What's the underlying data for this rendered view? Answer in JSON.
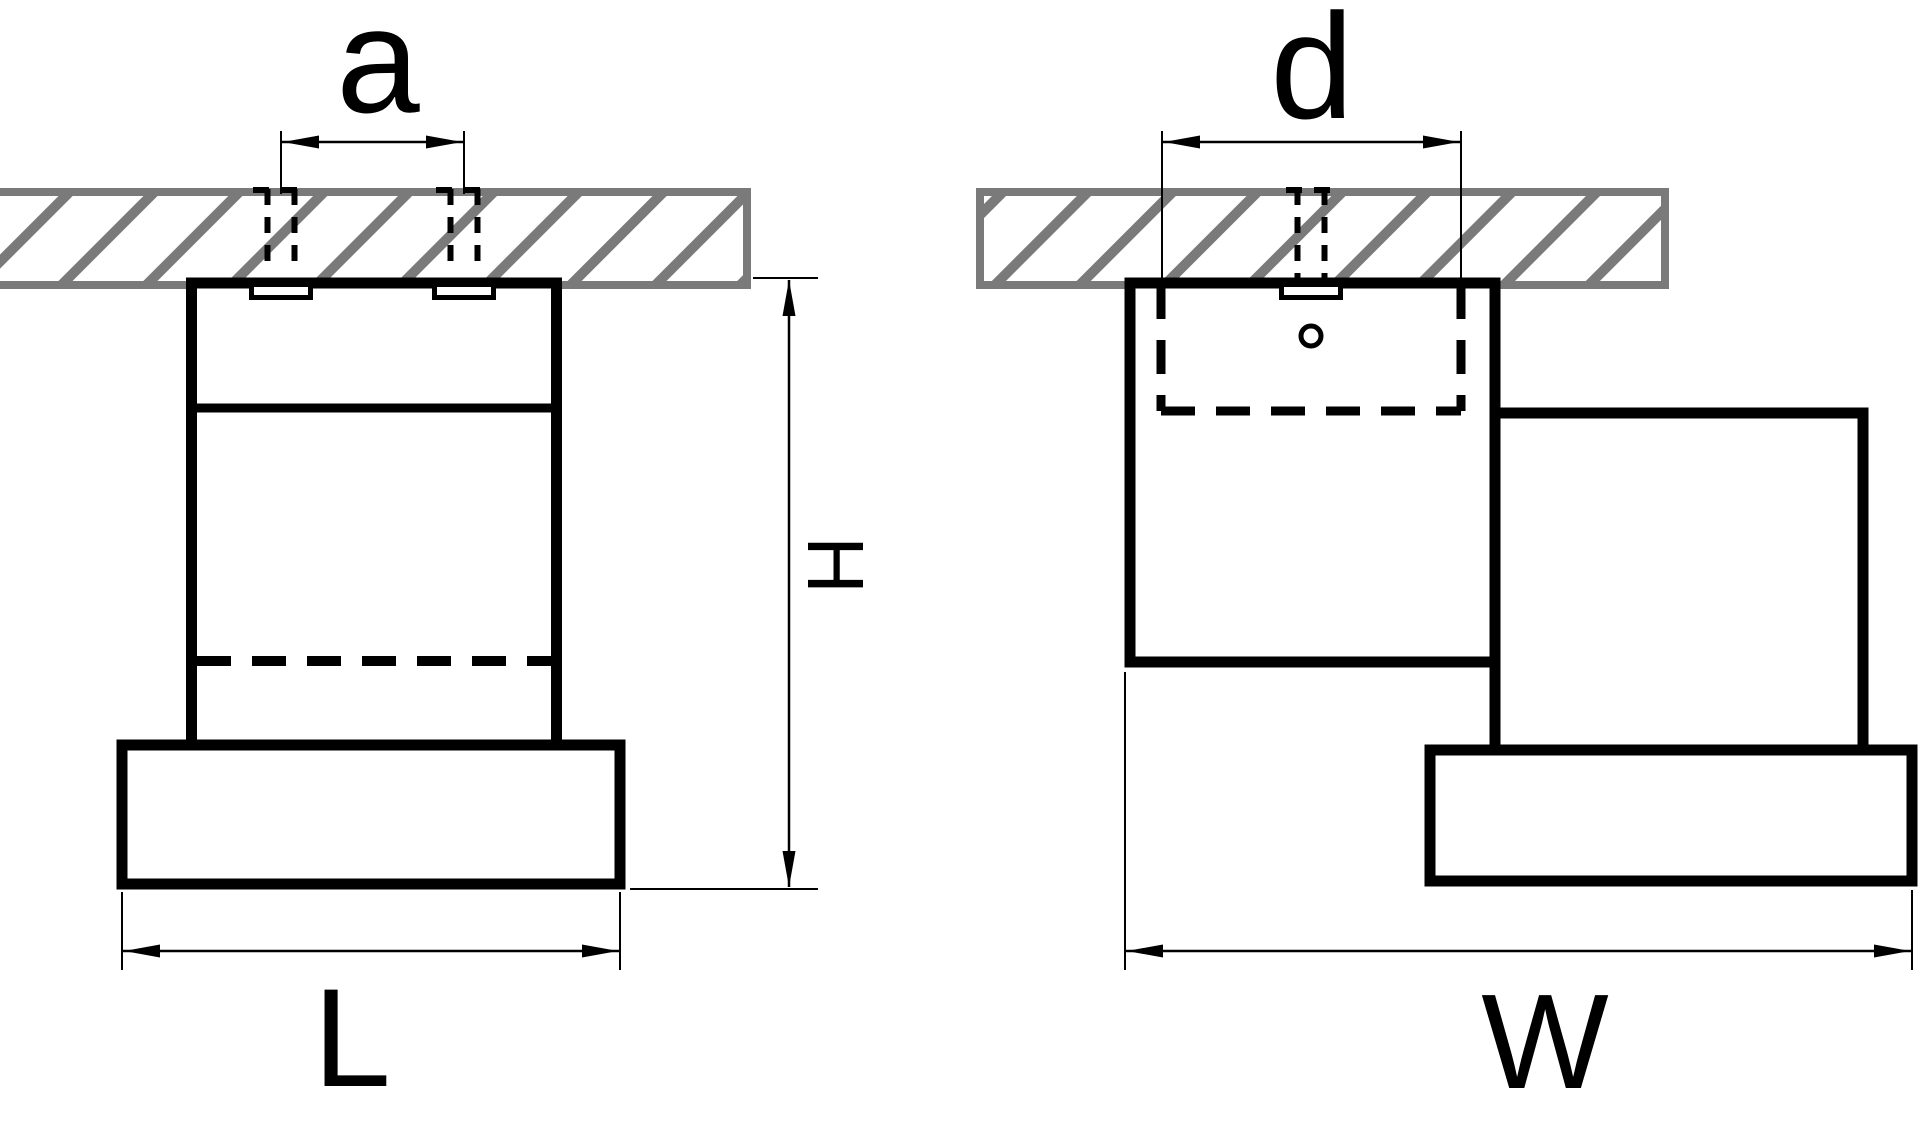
{
  "drawing": {
    "type": "technical-dimension-drawing",
    "subject": "ceiling-mounted spotlight luminaire shown in two orthographic views with hatched ceiling sections",
    "views": [
      {
        "id": "front-view",
        "dimensions": [
          "a",
          "H",
          "L"
        ]
      },
      {
        "id": "side-view",
        "dimensions": [
          "d",
          "W"
        ]
      }
    ],
    "labels": {
      "a": "a",
      "d": "d",
      "H": "H",
      "L": "L",
      "W": "W"
    },
    "colors": {
      "line": "#000000",
      "hatch_gray": "#7a7a7a",
      "background": "#ffffff"
    }
  }
}
